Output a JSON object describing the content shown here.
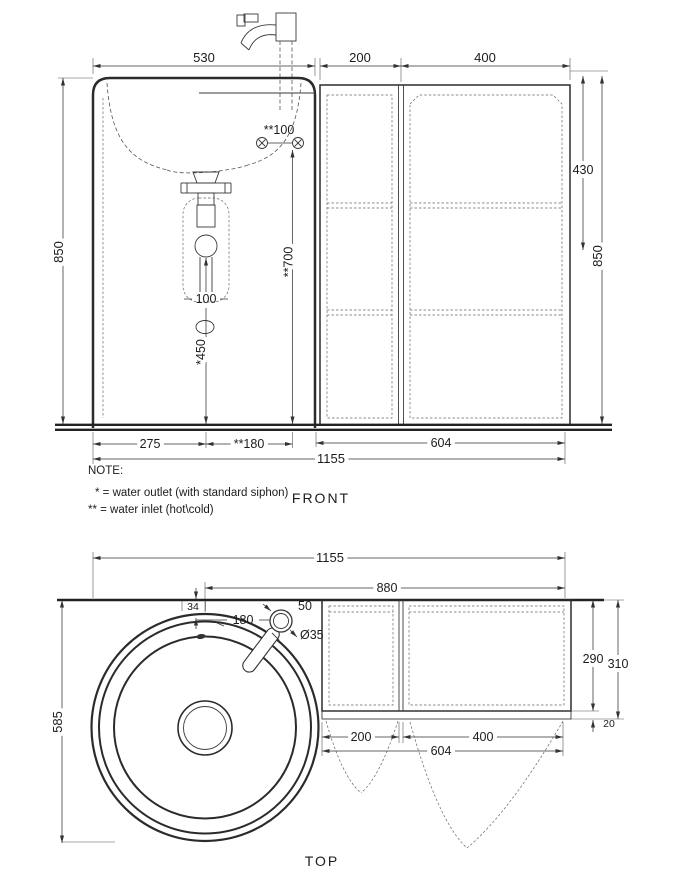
{
  "drawing": {
    "front_view": {
      "label": "FRONT",
      "dims": {
        "sink_width": "530",
        "cabinet_left_width": "200",
        "cabinet_right_width": "400",
        "shelf_height": "430",
        "height_left": "850",
        "height_right": "850",
        "inlet_spacing": "**100",
        "inlet_height": "**700",
        "outlet_height": "*450",
        "drain_width": "100",
        "drain_from_left": "275",
        "inlet_from_drain": "**180",
        "cabinet_width": "604",
        "total_width": "1155"
      },
      "note": {
        "title": "NOTE:",
        "line1": "* = water outlet (with standard siphon)",
        "line2": "** = water inlet (hot\\cold)"
      }
    },
    "top_view": {
      "label": "TOP",
      "dims": {
        "total_width": "1155",
        "center_to_right": "880",
        "rim_offset": "34",
        "faucet_offset": "180",
        "faucet_size": "50",
        "faucet_base_diameter": "Ø35",
        "basin_depth": "585",
        "cabinet_depth": "290",
        "total_depth": "310",
        "door_thickness": "20",
        "door_left_width": "200",
        "door_right_width": "400",
        "cabinet_width": "604"
      }
    }
  },
  "colors": {
    "line": "#2b2b2b",
    "background": "#ffffff"
  }
}
